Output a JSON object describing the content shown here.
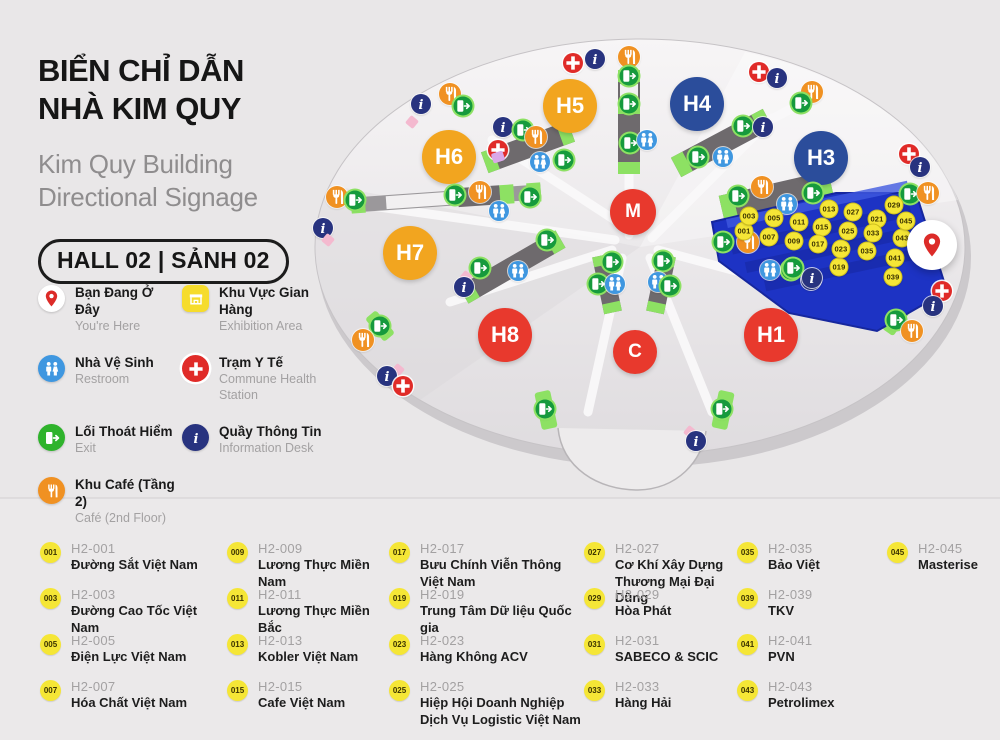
{
  "header": {
    "title_vi": [
      "BIỂN CHỈ DẪN",
      "NHÀ KIM QUY"
    ],
    "title_en": [
      "Kim Quy Building",
      "Directional Signage"
    ],
    "hall_badge": "HALL 02 | SẢNH 02"
  },
  "legend": {
    "items": [
      {
        "icon": "you-are-here",
        "title": "Bạn Đang Ở Đây",
        "sub": "You're Here"
      },
      {
        "icon": "exhibition",
        "title": "Khu Vực Gian Hàng",
        "sub": "Exhibition Area"
      },
      {
        "icon": "restroom",
        "title": "Nhà Vệ Sinh",
        "sub": "Restroom"
      },
      {
        "icon": "medical",
        "title": "Trạm Y Tế",
        "sub": "Commune Health Station"
      },
      {
        "icon": "exit",
        "title": "Lối Thoát Hiểm",
        "sub": "Exit"
      },
      {
        "icon": "information",
        "title": "Quầy Thông Tin",
        "sub": "Information Desk"
      },
      {
        "icon": "cafe",
        "title": "Khu Café (Tầng 2)",
        "sub": "Café (2nd Floor)"
      }
    ]
  },
  "map": {
    "halls": [
      {
        "label": "H5",
        "x": 570,
        "y": 106,
        "c": "orange",
        "size": 54
      },
      {
        "label": "H4",
        "x": 697,
        "y": 104,
        "c": "blue",
        "size": 54
      },
      {
        "label": "H6",
        "x": 449,
        "y": 157,
        "c": "orange",
        "size": 54
      },
      {
        "label": "H3",
        "x": 821,
        "y": 158,
        "c": "blue",
        "size": 54
      },
      {
        "label": "M",
        "x": 633,
        "y": 212,
        "c": "red",
        "size": 46
      },
      {
        "label": "H7",
        "x": 410,
        "y": 253,
        "c": "orange",
        "size": 54
      },
      {
        "label": "H8",
        "x": 505,
        "y": 335,
        "c": "red",
        "size": 54
      },
      {
        "label": "C",
        "x": 635,
        "y": 352,
        "c": "red",
        "size": 44
      },
      {
        "label": "H1",
        "x": 771,
        "y": 335,
        "c": "red",
        "size": 54
      }
    ],
    "markers": [
      {
        "t": "cross",
        "x": 573,
        "y": 63
      },
      {
        "t": "info",
        "x": 595,
        "y": 59
      },
      {
        "t": "cafe",
        "x": 629,
        "y": 57
      },
      {
        "t": "exit",
        "x": 629,
        "y": 76
      },
      {
        "t": "exit",
        "x": 629,
        "y": 104
      },
      {
        "t": "exit",
        "x": 630,
        "y": 143
      },
      {
        "t": "restroom",
        "x": 647,
        "y": 140
      },
      {
        "t": "info",
        "x": 421,
        "y": 104
      },
      {
        "t": "cafe",
        "x": 450,
        "y": 94
      },
      {
        "t": "exit",
        "x": 463,
        "y": 106
      },
      {
        "t": "pink",
        "x": 412,
        "y": 122
      },
      {
        "t": "info",
        "x": 503,
        "y": 127
      },
      {
        "t": "exit",
        "x": 523,
        "y": 130
      },
      {
        "t": "cross",
        "x": 498,
        "y": 150
      },
      {
        "t": "lav",
        "x": 498,
        "y": 157
      },
      {
        "t": "cafe",
        "x": 536,
        "y": 137
      },
      {
        "t": "restroom",
        "x": 540,
        "y": 162
      },
      {
        "t": "exit",
        "x": 564,
        "y": 160
      },
      {
        "t": "cross",
        "x": 759,
        "y": 72
      },
      {
        "t": "info",
        "x": 777,
        "y": 78
      },
      {
        "t": "cafe",
        "x": 812,
        "y": 92
      },
      {
        "t": "exit",
        "x": 801,
        "y": 103
      },
      {
        "t": "exit",
        "x": 743,
        "y": 126
      },
      {
        "t": "info",
        "x": 763,
        "y": 127
      },
      {
        "t": "exit",
        "x": 698,
        "y": 157
      },
      {
        "t": "restroom",
        "x": 723,
        "y": 157
      },
      {
        "t": "cross",
        "x": 909,
        "y": 154
      },
      {
        "t": "info",
        "x": 920,
        "y": 167
      },
      {
        "t": "cafe",
        "x": 337,
        "y": 197
      },
      {
        "t": "exit",
        "x": 355,
        "y": 200
      },
      {
        "t": "exit",
        "x": 455,
        "y": 195
      },
      {
        "t": "cafe",
        "x": 480,
        "y": 192
      },
      {
        "t": "restroom",
        "x": 499,
        "y": 211
      },
      {
        "t": "exit",
        "x": 530,
        "y": 197
      },
      {
        "t": "info",
        "x": 323,
        "y": 228
      },
      {
        "t": "pink",
        "x": 328,
        "y": 240
      },
      {
        "t": "exit",
        "x": 547,
        "y": 240
      },
      {
        "t": "exit",
        "x": 480,
        "y": 268
      },
      {
        "t": "restroom",
        "x": 518,
        "y": 271
      },
      {
        "t": "pink",
        "x": 466,
        "y": 277
      },
      {
        "t": "info",
        "x": 464,
        "y": 287
      },
      {
        "t": "exit",
        "x": 380,
        "y": 326
      },
      {
        "t": "cafe",
        "x": 363,
        "y": 340
      },
      {
        "t": "pink",
        "x": 398,
        "y": 370
      },
      {
        "t": "info",
        "x": 387,
        "y": 376
      },
      {
        "t": "cross",
        "x": 403,
        "y": 386
      },
      {
        "t": "exit",
        "x": 612,
        "y": 262
      },
      {
        "t": "exit",
        "x": 598,
        "y": 284
      },
      {
        "t": "restroom",
        "x": 615,
        "y": 284
      },
      {
        "t": "exit",
        "x": 663,
        "y": 261
      },
      {
        "t": "restroom",
        "x": 658,
        "y": 282
      },
      {
        "t": "exit",
        "x": 670,
        "y": 286
      },
      {
        "t": "exit",
        "x": 545,
        "y": 409
      },
      {
        "t": "exit",
        "x": 722,
        "y": 409
      },
      {
        "t": "pink",
        "x": 690,
        "y": 432
      },
      {
        "t": "info",
        "x": 696,
        "y": 441
      },
      {
        "t": "exit",
        "x": 791,
        "y": 270
      },
      {
        "t": "info",
        "x": 811,
        "y": 280
      },
      {
        "t": "cafe",
        "x": 762,
        "y": 187
      },
      {
        "t": "exit",
        "x": 738,
        "y": 196
      },
      {
        "t": "exit",
        "x": 813,
        "y": 193
      },
      {
        "t": "restroom",
        "x": 787,
        "y": 204
      },
      {
        "t": "exit",
        "x": 910,
        "y": 194
      },
      {
        "t": "cafe",
        "x": 928,
        "y": 193
      },
      {
        "t": "exit",
        "x": 723,
        "y": 242
      },
      {
        "t": "cafe",
        "x": 748,
        "y": 242
      },
      {
        "t": "restroom",
        "x": 770,
        "y": 270
      },
      {
        "t": "exit",
        "x": 793,
        "y": 268
      },
      {
        "t": "info",
        "x": 812,
        "y": 278
      },
      {
        "t": "exit",
        "x": 896,
        "y": 320
      },
      {
        "t": "cafe",
        "x": 912,
        "y": 331
      },
      {
        "t": "cross",
        "x": 942,
        "y": 291
      },
      {
        "t": "info",
        "x": 933,
        "y": 306
      }
    ],
    "booths": [
      {
        "n": "001",
        "x": 744,
        "y": 231
      },
      {
        "n": "003",
        "x": 749,
        "y": 216
      },
      {
        "n": "005",
        "x": 774,
        "y": 218
      },
      {
        "n": "007",
        "x": 769,
        "y": 237
      },
      {
        "n": "009",
        "x": 794,
        "y": 241
      },
      {
        "n": "011",
        "x": 799,
        "y": 222
      },
      {
        "n": "013",
        "x": 829,
        "y": 209
      },
      {
        "n": "015",
        "x": 822,
        "y": 227
      },
      {
        "n": "017",
        "x": 818,
        "y": 244
      },
      {
        "n": "019",
        "x": 839,
        "y": 267
      },
      {
        "n": "021",
        "x": 877,
        "y": 219
      },
      {
        "n": "023",
        "x": 841,
        "y": 249
      },
      {
        "n": "025",
        "x": 848,
        "y": 231
      },
      {
        "n": "027",
        "x": 853,
        "y": 212
      },
      {
        "n": "029",
        "x": 894,
        "y": 205
      },
      {
        "n": "033",
        "x": 873,
        "y": 233
      },
      {
        "n": "035",
        "x": 867,
        "y": 251
      },
      {
        "n": "039",
        "x": 893,
        "y": 277
      },
      {
        "n": "041",
        "x": 895,
        "y": 258
      },
      {
        "n": "043",
        "x": 902,
        "y": 238
      },
      {
        "n": "045",
        "x": 906,
        "y": 221
      }
    ],
    "you_are_here": {
      "x": 932,
      "y": 245
    }
  },
  "directory": {
    "columns": [
      [
        {
          "num": "001",
          "code": "H2-001",
          "name": "Đường Sắt Việt Nam"
        },
        {
          "num": "003",
          "code": "H2-003",
          "name": "Đường Cao Tốc Việt Nam"
        },
        {
          "num": "005",
          "code": "H2-005",
          "name": "Điện Lực Việt Nam"
        },
        {
          "num": "007",
          "code": "H2-007",
          "name": "Hóa Chất Việt Nam"
        }
      ],
      [
        {
          "num": "009",
          "code": "H2-009",
          "name": "Lương Thực Miền Nam"
        },
        {
          "num": "011",
          "code": "H2-011",
          "name": "Lương Thực Miền Bắc"
        },
        {
          "num": "013",
          "code": "H2-013",
          "name": "Kobler Việt Nam"
        },
        {
          "num": "015",
          "code": "H2-015",
          "name": "Cafe Việt Nam"
        }
      ],
      [
        {
          "num": "017",
          "code": "H2-017",
          "name": "Bưu Chính Viễn Thông Việt Nam"
        },
        {
          "num": "019",
          "code": "H2-019",
          "name": "Trung Tâm Dữ liệu Quốc gia"
        },
        {
          "num": "023",
          "code": "H2-023",
          "name": "Hàng Không ACV"
        },
        {
          "num": "025",
          "code": "H2-025",
          "name": "Hiệp Hội Doanh Nghiệp Dịch Vụ Logistic Việt Nam"
        }
      ],
      [
        {
          "num": "027",
          "code": "H2-027",
          "name": "Cơ Khí Xây Dựng Thương Mại Đại Dũng"
        },
        {
          "num": "029",
          "code": "H2-029",
          "name": "Hòa Phát"
        },
        {
          "num": "031",
          "code": "H2-031",
          "name": "SABECO & SCIC"
        },
        {
          "num": "033",
          "code": "H2-033",
          "name": "Hàng Hải"
        }
      ],
      [
        {
          "num": "035",
          "code": "H2-035",
          "name": "Bảo Việt"
        },
        {
          "num": "039",
          "code": "H2-039",
          "name": "TKV"
        },
        {
          "num": "041",
          "code": "H2-041",
          "name": "PVN"
        },
        {
          "num": "043",
          "code": "H2-043",
          "name": "Petrolimex"
        }
      ],
      [
        {
          "num": "045",
          "code": "H2-045",
          "name": "Masterise"
        }
      ]
    ]
  },
  "palette": {
    "background": "#E9E7E8",
    "subtitle_text": "#8F8D8E",
    "hall_orange": "#F2A51F",
    "hall_blue": "#2B4D9B",
    "hall_red": "#E8392D",
    "booth_area_blue": "#1D33C4",
    "booth_dot_yellow": "#F5E636",
    "corridor_gray": "#6E6A6D",
    "corridor_green": "#8DE163",
    "exit_green": "#169A3D",
    "info_navy": "#28337F",
    "medical_red": "#E02B28",
    "restroom_blue": "#3F97E0",
    "cafe_orange": "#F09122",
    "pin_red": "#DC2B28"
  }
}
